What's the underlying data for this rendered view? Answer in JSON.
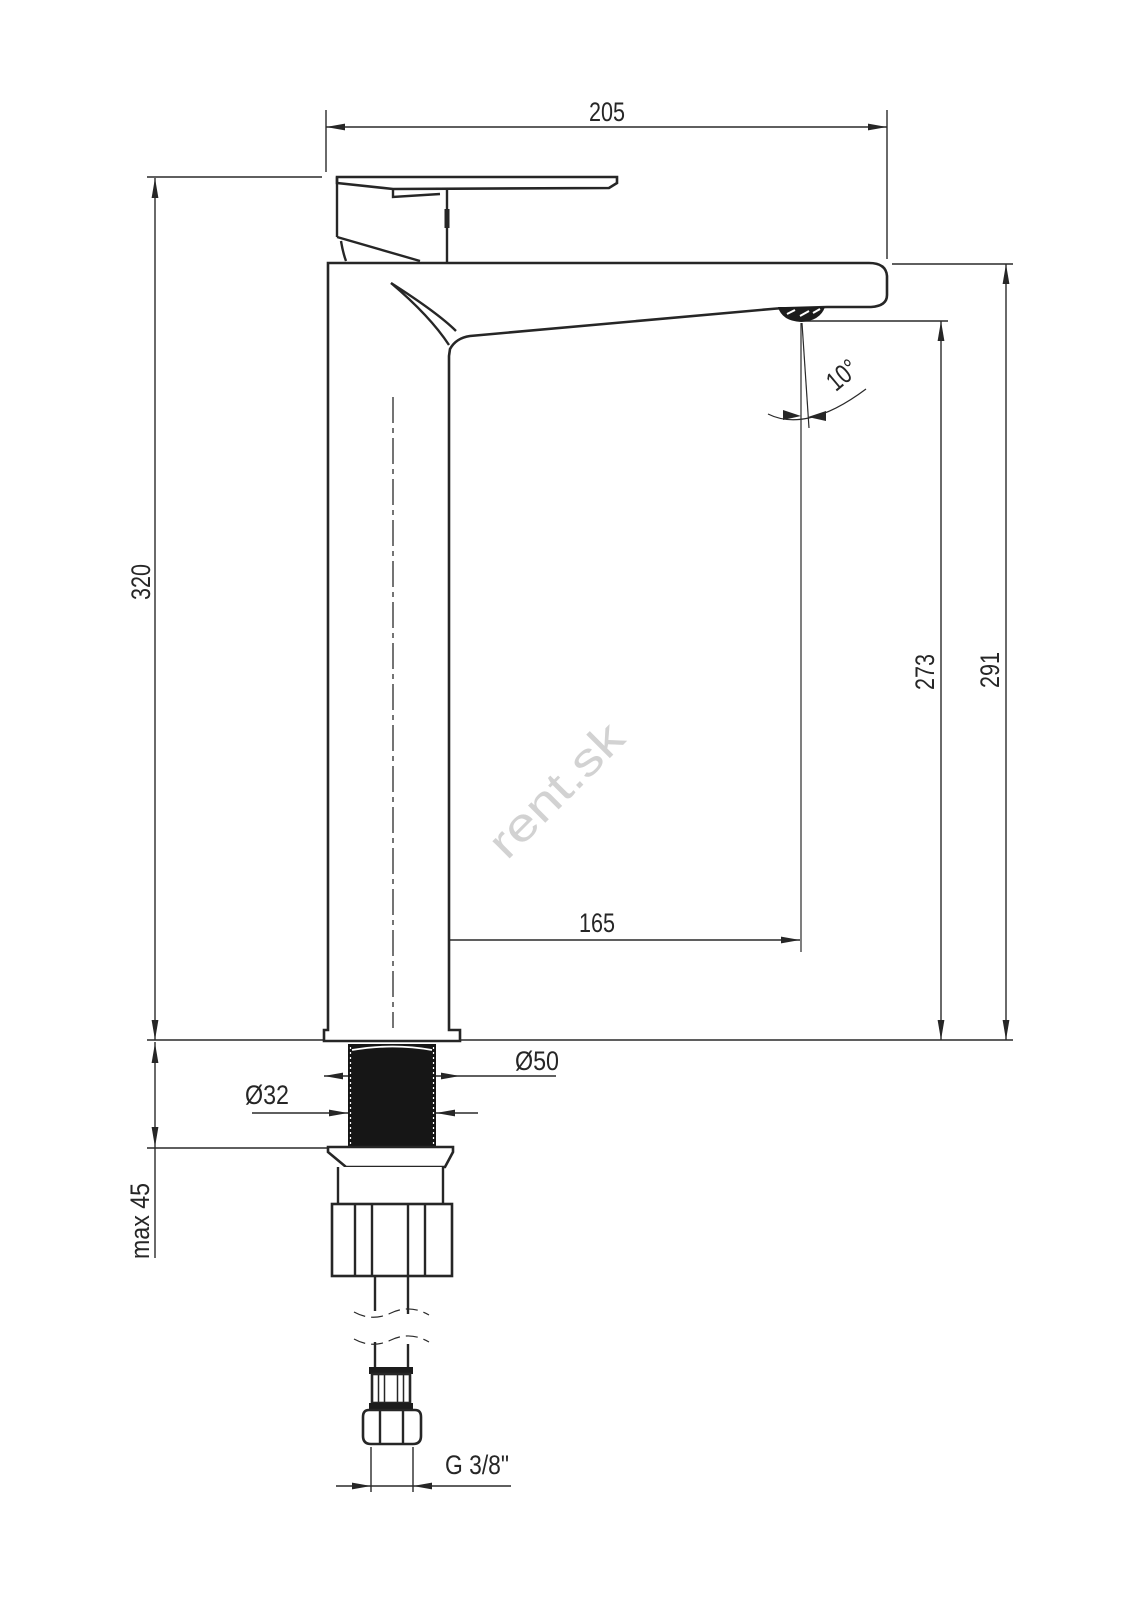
{
  "watermark": "rent.sk",
  "dimensions": {
    "total_length": "205",
    "body_height": "320",
    "outlet_height": "273",
    "spout_top_height": "291",
    "spout_reach": "165",
    "outlet_angle": "10°",
    "base_diameter": "Ø50",
    "shank_diameter": "Ø32",
    "max_mounting_thickness": "max 45",
    "connection_thread": "G 3/8\""
  }
}
